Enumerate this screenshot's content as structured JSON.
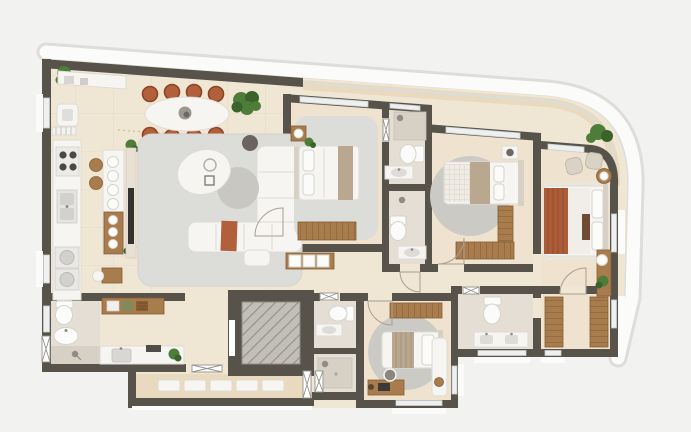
{
  "scene": {
    "kind": "residential apartment floor plan, rendered top-down 3D view",
    "text_labels_visible": "none",
    "building_outline": "wide irregular slab with slanted top edge and large rounded top-right corner, white facade band around top and right edges"
  },
  "colors": {
    "bg": "#f2f2f1",
    "facade": "#fbfbfa",
    "facade_edge": "#deddda",
    "wall": "#57534b",
    "floor_main": "#f0e6d4",
    "floor_balcony": "#e9d9bf",
    "floor_bedroom": "#efe3cf",
    "floor_bath": "#e4ded4",
    "floor_shower": "#d6d0c5",
    "rug": "#dcdcd8",
    "rug_round": "#cbcac5",
    "furn_white": "#f6f5f2",
    "furn_stroke": "#dfdcd5",
    "wood": "#a97c4e",
    "wood_dark": "#855d34",
    "terracotta": "#b2603c",
    "terracotta_dark": "#8c4524",
    "rust": "#ad5c3a",
    "taupe": "#b9a88f",
    "headboard": "#d7d0c4",
    "plant": "#4e7d3a",
    "plant_dark": "#3a6329",
    "metal": "#8f8c86",
    "window": "#eef0ef",
    "window_frame": "#c9cdcc",
    "elevator_shaft": "#c2bfb9",
    "hatch": "#96938c",
    "tv": "#34322e"
  },
  "rooms": [
    {
      "id": "service-balcony",
      "location": "left edge strip",
      "items": [
        "plant",
        "wash-basin",
        "louver-grille"
      ]
    },
    {
      "id": "kitchen",
      "location": "left",
      "items": [
        "wall-counter",
        "cooktop-4-burner",
        "double-sink",
        "washer",
        "dryer",
        "upper-counter-small-appliances",
        {
          "name": "island-counter-with-tableware",
          "plates": 7
        },
        {
          "name": "bar-stool",
          "count": 2
        },
        {
          "name": "plant",
          "count": 2
        }
      ]
    },
    {
      "id": "dining-area",
      "location": "top-left",
      "items": [
        "oval-dining-table",
        "centerpiece-bowl",
        {
          "name": "dining-chair",
          "count": 8,
          "color": "terracotta"
        },
        "floor-plant",
        "dotted-ceiling-projection-line"
      ]
    },
    {
      "id": "living-room",
      "location": "center-left",
      "items": [
        "large-area-rug",
        "l-shaped-modular-sofa",
        "terracotta-throw",
        "ottoman",
        "organic-white-coffee-table",
        "round-gray-coffee-table",
        "dark-round-side-table",
        "tv-panel",
        "writing-desk",
        "desk-chair"
      ]
    },
    {
      "id": "bedroom-1",
      "location": "center, left of bathrooms",
      "items": [
        "area-rug",
        "double-bed",
        "nightstand",
        "ball-lamp",
        "plant",
        "wardrobe-sideboard",
        {
          "name": "shoe-cubby",
          "count": 3
        },
        "window"
      ]
    },
    {
      "id": "bathroom-1",
      "location": "between bedroom-1 and bedroom-2, upper",
      "items": [
        "shower",
        "glass-door",
        "toilet",
        "vanity-sink"
      ]
    },
    {
      "id": "bathroom-2",
      "location": "between bedroom-1 and bedroom-2, lower",
      "items": [
        "shower-head",
        "toilet",
        "vanity-sink"
      ]
    },
    {
      "id": "bedroom-2",
      "location": "center-right",
      "items": [
        "round-rug",
        "double-bed",
        "nightstand",
        "l-shaped-wardrobe",
        "window"
      ]
    },
    {
      "id": "master-bedroom",
      "location": "right, under curved corner",
      "items": [
        "double-bed-rust-runner",
        "bed-bench",
        {
          "name": "armchair",
          "count": 2
        },
        "round-side-table",
        "wall-desk",
        "stool",
        "plant",
        "window"
      ]
    },
    {
      "id": "master-closet",
      "location": "bottom-right",
      "items": [
        {
          "name": "wardrobe-unit",
          "count": 2
        },
        "window"
      ]
    },
    {
      "id": "master-bathroom",
      "location": "bottom-right of center",
      "items": [
        "toilet",
        "double-vanity-sink",
        "window",
        "hatched-door"
      ]
    },
    {
      "id": "bedroom-3",
      "location": "bottom-center",
      "items": [
        "round-rug",
        "bed",
        "wardrobe",
        "desk",
        "laptop",
        "desk-chair",
        "window-seat-bench",
        "window"
      ]
    },
    {
      "id": "service-bathroom",
      "location": "bottom-center-left",
      "items": [
        "toilet",
        "vanity-sink",
        "hatched-door"
      ]
    },
    {
      "id": "service-shower-room",
      "location": "below service-bathroom",
      "items": [
        "shower-tray",
        "shower-head"
      ]
    },
    {
      "id": "powder-bathroom",
      "location": "bottom-left",
      "items": [
        "toilet",
        "pedestal-sink",
        "shower-area",
        "hatched-door",
        "window"
      ]
    },
    {
      "id": "laundry",
      "location": "bottom-left",
      "items": [
        "wall-shelf-with-boxes",
        "storage-basket",
        "counter-with-sink",
        "dark-appliance",
        "plant",
        "hatched-door"
      ]
    },
    {
      "id": "entry-hall",
      "location": "bottom-left of living room",
      "items": []
    },
    {
      "id": "elevator",
      "location": "bottom-center",
      "items": [
        "diagonal-hatched-shaft",
        "elevator-door"
      ]
    },
    {
      "id": "common-corridor",
      "location": "bottom strip",
      "items": [
        {
          "name": "white-bench-unit",
          "count": 5
        },
        {
          "name": "hatched-door-panel",
          "count": 2
        }
      ]
    },
    {
      "id": "top-balcony",
      "location": "slanted strip along top edge",
      "items": [
        "plant",
        "glass-railing"
      ]
    }
  ]
}
